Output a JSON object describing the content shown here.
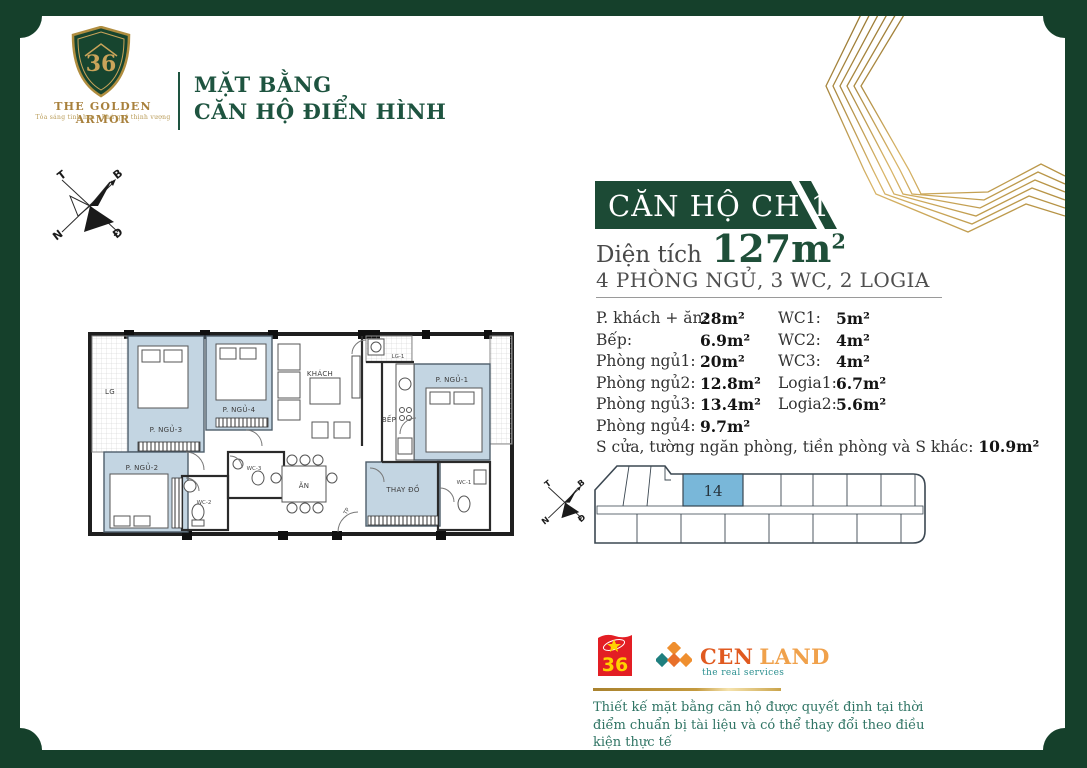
{
  "colors": {
    "frame_green": "#15402b",
    "banner_green": "#1c4a35",
    "header_green": "#1e5440",
    "accent_gold": "#b08d3f",
    "unit_highlight_blue": "#79b7d9",
    "room_blue": "#c3d5e2",
    "cen_orange": "#e05a20",
    "cen_teal": "#2a8f8f",
    "logo36_red": "#e31e24",
    "disclaimer_teal": "#2f7464"
  },
  "logo": {
    "name": "THE GOLDEN ARMOR",
    "tagline": "Tỏa sáng tinh hoa - Phú quý thịnh vượng"
  },
  "header": {
    "line1": "MẶT BẰNG",
    "line2": "CĂN HỘ ĐIỂN HÌNH"
  },
  "apartment": {
    "title": "CĂN HỘ CH 14",
    "area_label": "Diện tích",
    "area_value": "127m",
    "area_sup": "2",
    "summary": "4 PHÒNG NGỦ, 3 WC, 2 LOGIA",
    "specs_left": [
      {
        "label": "P. khách + ăn:",
        "value": "28m²"
      },
      {
        "label": "Bếp:",
        "value": "6.9m²"
      },
      {
        "label": "Phòng ngủ1:",
        "value": "20m²"
      },
      {
        "label": "Phòng ngủ2:",
        "value": "12.8m²"
      },
      {
        "label": "Phòng ngủ3:",
        "value": "13.4m²"
      },
      {
        "label": "Phòng ngủ4:",
        "value": "9.7m²"
      }
    ],
    "specs_right": [
      {
        "label": "WC1:",
        "value": "5m²"
      },
      {
        "label": "WC2:",
        "value": "4m²"
      },
      {
        "label": "WC3:",
        "value": "4m²"
      },
      {
        "label": "Logia1:",
        "value": "6.7m²"
      },
      {
        "label": "Logia2:",
        "value": "5.6m²"
      }
    ],
    "note_label": "S cửa, tường ngăn phòng, tiền phòng và S khác:",
    "note_value": "10.9m²"
  },
  "floor_plan": {
    "rooms": [
      "LG",
      "P. NGỦ-3",
      "P. NGỦ-4",
      "KHÁCH",
      "LG-1",
      "BẾP",
      "P. NGỦ-1",
      "P. NGỦ-2",
      "WC-2",
      "WC-3",
      "ĂN",
      "TP",
      "THAY ĐỒ",
      "WC-1"
    ]
  },
  "key_plan": {
    "unit": "14"
  },
  "compass": {
    "north": "B",
    "east": "Đ",
    "south": "N",
    "west": "T"
  },
  "footer": {
    "logo36_number": "36",
    "cen": "CEN",
    "land": "LAND",
    "cen_subtitle": "the real services",
    "disclaimer_line1": "Thiết kế mặt bằng căn hộ được quyết định tại thời điểm chuẩn bị tài liệu",
    "disclaimer_line2": "và có thể thay đổi theo điều kiện thực tế"
  }
}
